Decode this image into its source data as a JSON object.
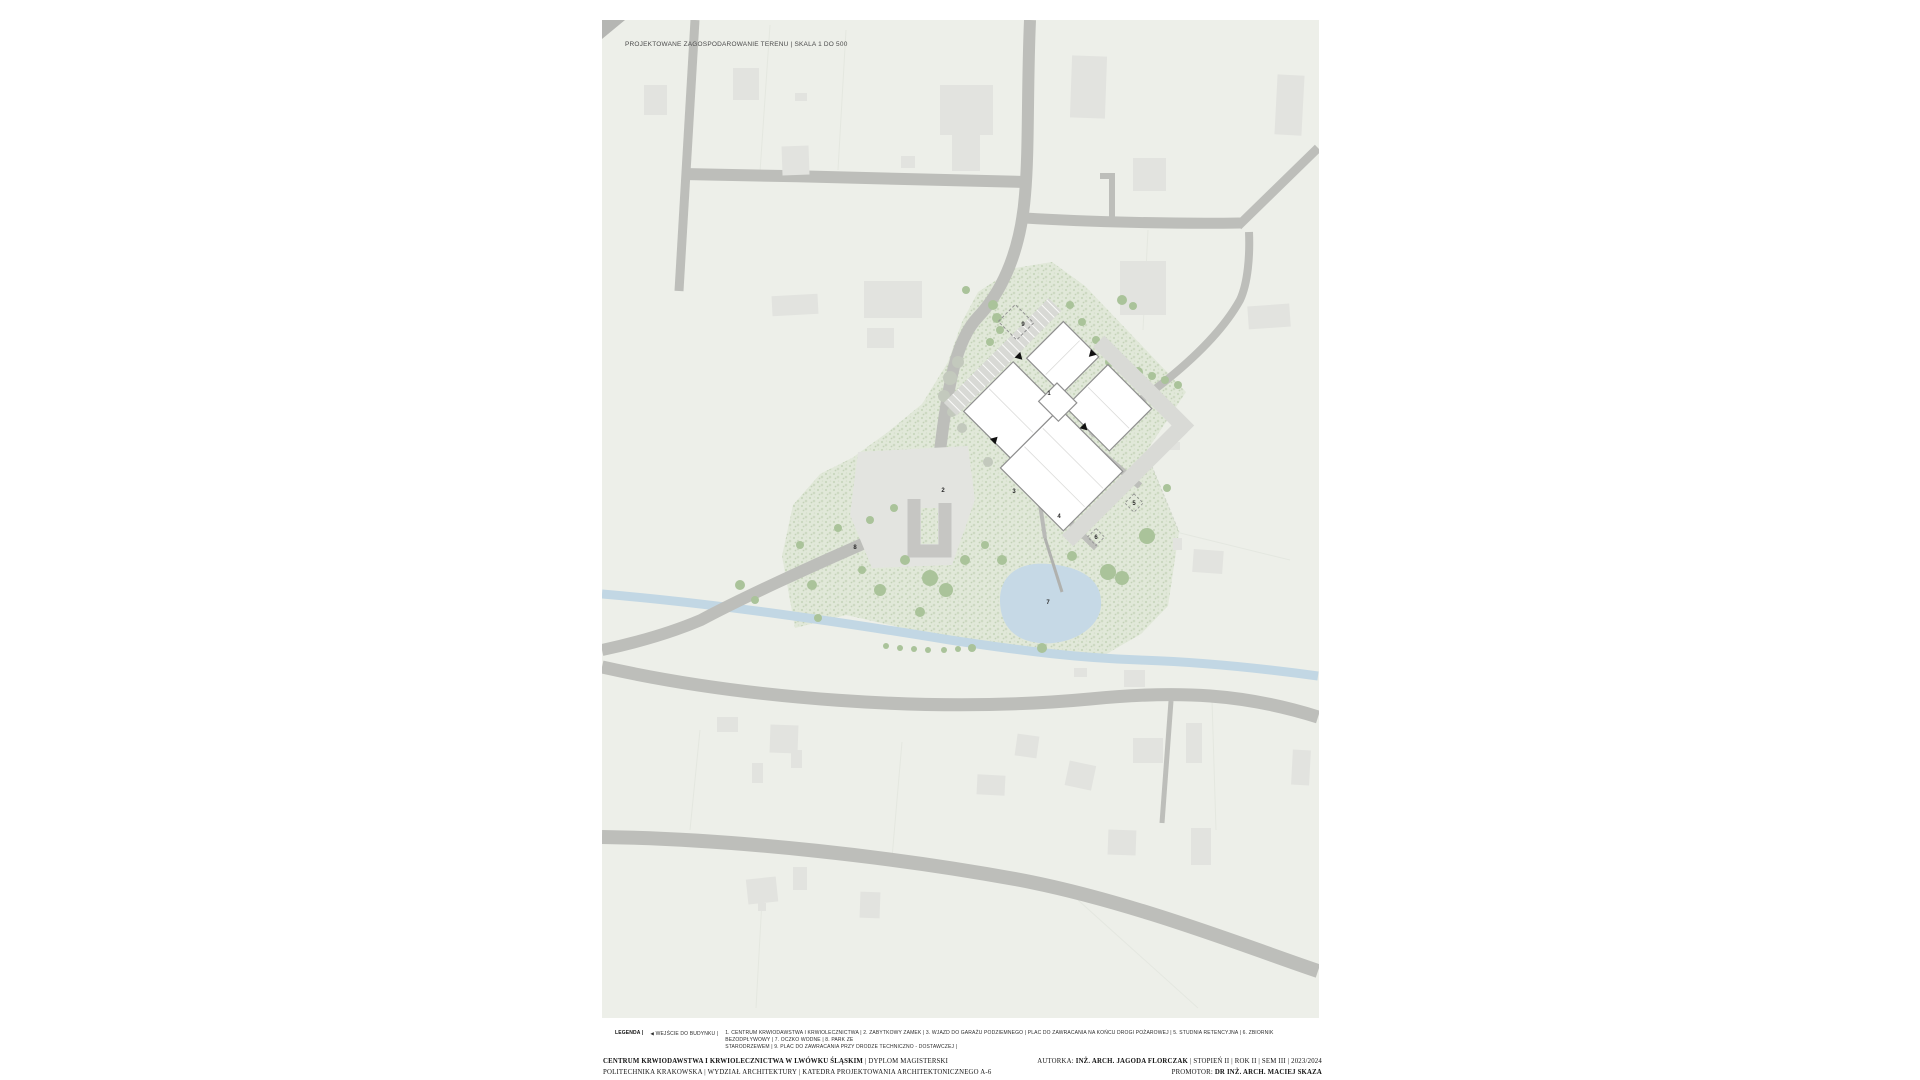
{
  "title": "PROJEKTOWANE ZAGOSPODAROWANIE TERENU | SKALA 1 DO 500",
  "legend": {
    "label": "LEGENDA |",
    "entrance_arrow": "◀",
    "entrance_text": "WEJŚCIE DO BUDYNKU |",
    "items_line1": "1. CENTRUM KRWIODAWSTWA I KRWIOLECZNICTWA | 2. ZABYTKOWY ZAMEK | 3. WJAZD DO GARAŻU PODZIEMNEGO | PLAC DO ZAWRACANIA NA KOŃCU DROGI POŻAROWEJ | 5. STUDNIA RETENCYJNA | 6. ZBIORNIK BEZODPŁYWOWY | 7. OCZKO WODNE | 8. PARK ZE",
    "items_line2": "STARODRZEWEM | 9. PLAC DO ZAWRACANIA PRZY DRODZE TECHNICZNO - DOSTAWCZEJ |"
  },
  "footer": {
    "left_line1_bold": "CENTRUM KRWIODAWSTWA I KRWIOLECZNICTWA W LWÓWKU ŚLĄSKIM",
    "left_line1_rest": " | DYPLOM MAGISTERSKI",
    "left_line2": "POLITECHNIKA KRAKOWSKA | WYDZIAŁ ARCHITEKTURY | KATEDRA PROJEKTOWANIA ARCHITEKTONICZNEGO A-6",
    "right_line1_prefix": "AUTORKA: ",
    "right_line1_bold": "INŻ. ARCH. JAGODA FLORCZAK",
    "right_line1_rest": " | STOPIEŃ II | ROK II | SEM III | 2023/2024",
    "right_line2_prefix": "PROMOTOR: ",
    "right_line2_bold": "DR INŻ. ARCH. MACIEJ SKAZA"
  },
  "map": {
    "scale_note": "SKALA 1 DO 500",
    "colors": {
      "paper": "#ffffff",
      "terrain": "#edefe9",
      "road": "#bdbeba",
      "building_context": "#e2e3df",
      "building_designed": "#ffffff",
      "building_outline": "#8f8f8f",
      "vegetation_base": "#e1e8d9",
      "vegetation_dot": "#c9d6bd",
      "tree": "#aac39a",
      "water": "#c6d9e6",
      "label_text": "#2a2a2a"
    },
    "labels": [
      {
        "n": "1",
        "x": 1049,
        "y": 395,
        "name": "centrum-krwiodawstwa-i-krwiolecznictwa"
      },
      {
        "n": "2",
        "x": 943,
        "y": 492,
        "name": "zabytkowy-zamek"
      },
      {
        "n": "3",
        "x": 1014,
        "y": 493,
        "name": "wjazd-do-garazu-podziemnego"
      },
      {
        "n": "4",
        "x": 1059,
        "y": 518,
        "name": "plac-do-zawracania-droga-pozarowa"
      },
      {
        "n": "5",
        "x": 1134,
        "y": 505,
        "name": "studnia-retencyjna"
      },
      {
        "n": "6",
        "x": 1096,
        "y": 539,
        "name": "zbiornik-bezodplywowy"
      },
      {
        "n": "7",
        "x": 1048,
        "y": 604,
        "name": "oczko-wodne"
      },
      {
        "n": "8",
        "x": 855,
        "y": 549,
        "name": "park-ze-starodrzewem"
      },
      {
        "n": "9",
        "x": 1023,
        "y": 326,
        "name": "plac-do-zawracania-droga-techniczno-dostawcza"
      }
    ]
  }
}
